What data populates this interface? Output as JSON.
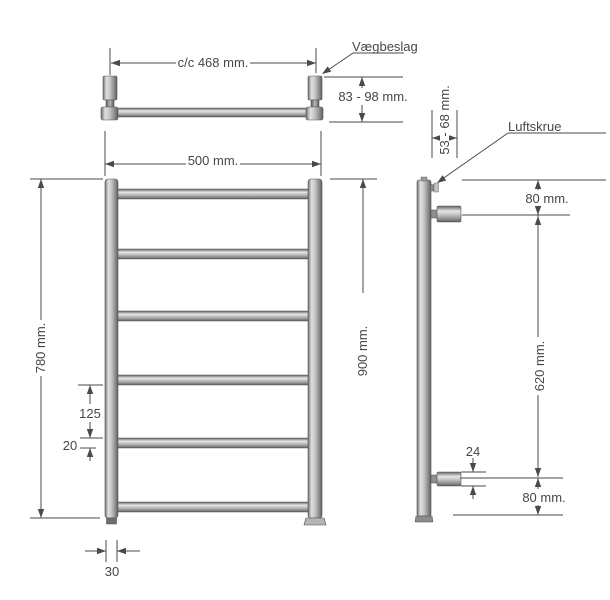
{
  "drawing": {
    "title": "towel-radiator-technical-drawing",
    "top_view": {
      "center_distance": "c/c 468 mm.",
      "wall_bracket_label": "Vægbeslag",
      "wall_distance": "83 - 98 mm."
    },
    "front_view": {
      "width": "500 mm.",
      "height_left": "780 mm.",
      "height_right": "900 mm.",
      "bar_spacing": "125",
      "bar_diameter": "20",
      "rail_width": "30"
    },
    "side_view": {
      "bracket_depth": "53 - 68 mm.",
      "air_screw_label": "Luftskrue",
      "top_offset": "80 mm.",
      "bracket_span": "620 mm.",
      "bracket_diameter": "24",
      "bottom_offset": "80 mm."
    },
    "colors": {
      "line": "#4a4a4a",
      "metal_light": "#e3e3e3",
      "metal_mid": "#b5b5b5",
      "metal_dark": "#5e5e5e",
      "background": "#ffffff"
    }
  }
}
